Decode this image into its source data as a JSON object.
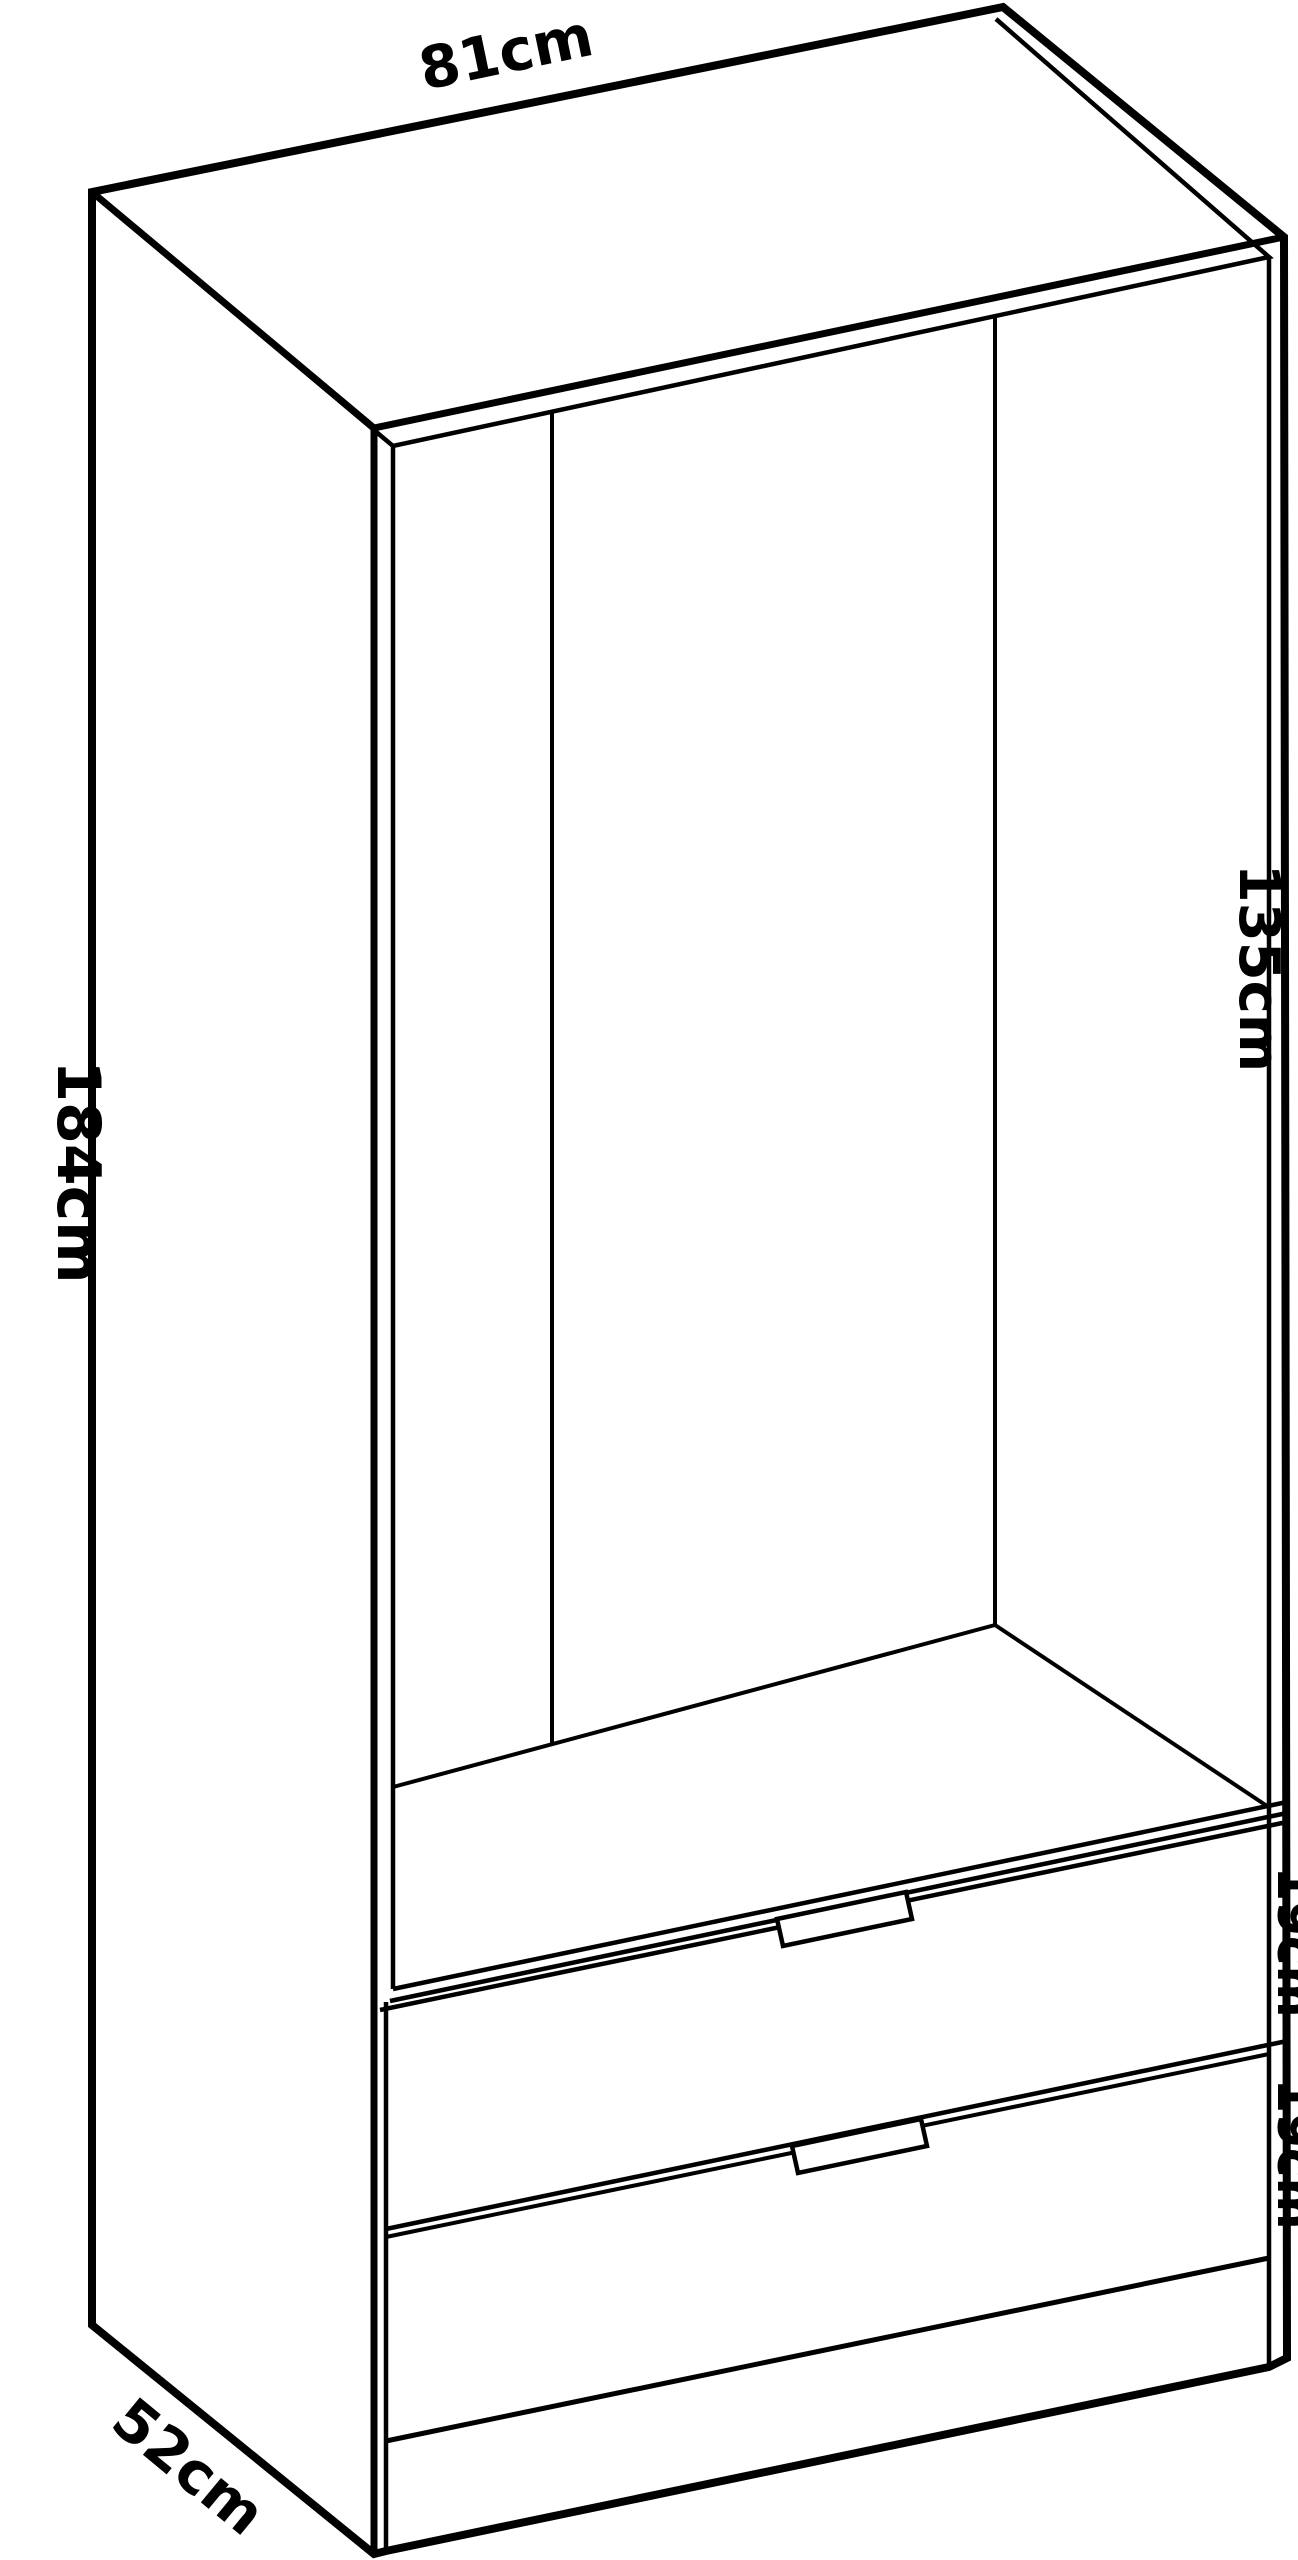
{
  "colors": {
    "background": "#ffffff",
    "line": "#000000",
    "text": "#000000"
  },
  "labels": {
    "width_top": {
      "text": "81cm"
    },
    "height_left": {
      "text": "184cm"
    },
    "interior_height_right": {
      "text": "135cm"
    },
    "drawer_one": {
      "text": "19cm"
    },
    "drawer_two": {
      "text": "19cm"
    },
    "depth_bottom": {
      "text": "52cm"
    }
  }
}
